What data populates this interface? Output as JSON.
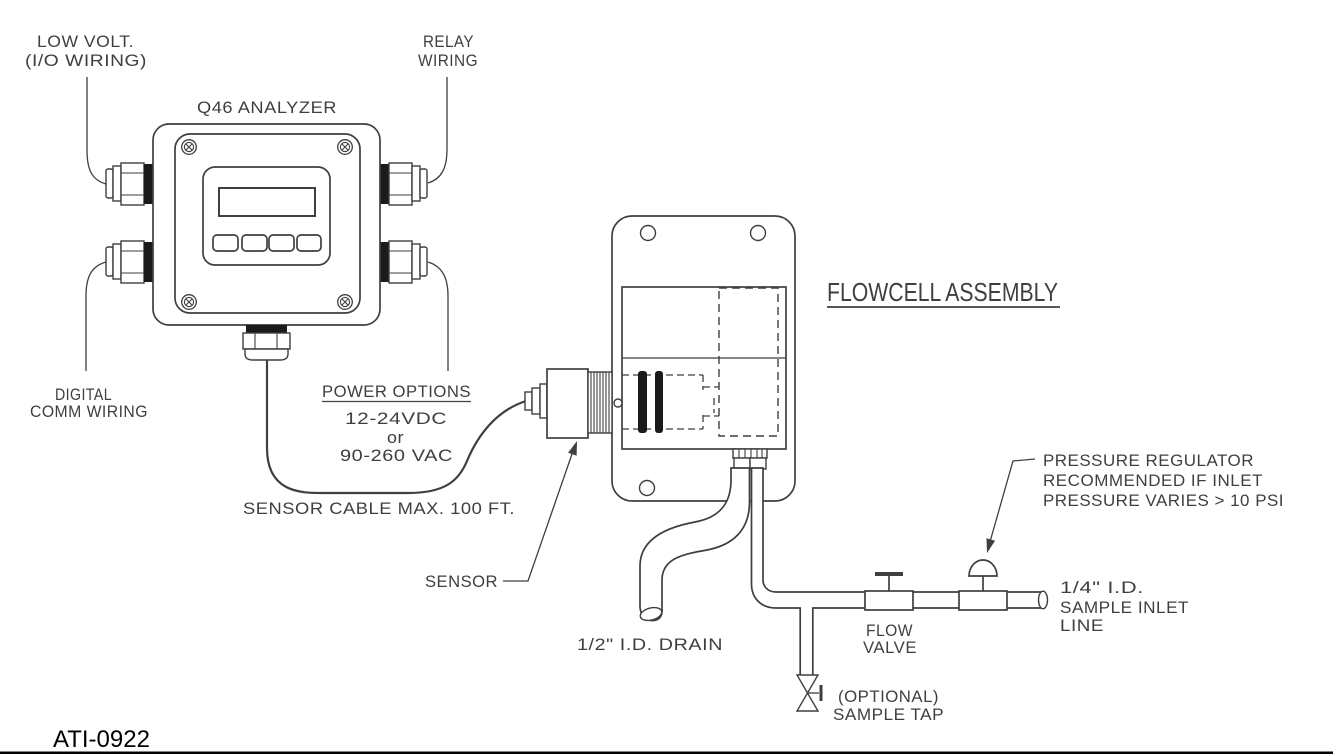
{
  "drawing": {
    "number": "ATI-0922"
  },
  "colors": {
    "line": "#3f3f3f",
    "dark_fill": "#1b1b1b",
    "background": "#ffffff",
    "footer_text": "#000000"
  },
  "analyzer": {
    "title": "Q46 ANALYZER",
    "wiring_labels": {
      "low_volt": [
        "LOW VOLT.",
        "(I/O WIRING)"
      ],
      "relay": [
        "RELAY",
        "WIRING"
      ],
      "digital_comm": [
        "DIGITAL",
        "COMM WIRING"
      ]
    },
    "power": {
      "heading": "POWER OPTIONS",
      "options": [
        "12-24VDC",
        "or",
        "90-260 VAC"
      ]
    },
    "cable_note": "SENSOR CABLE MAX. 100 FT."
  },
  "flowcell": {
    "heading": "FLOWCELL ASSEMBLY",
    "sensor_label": "SENSOR",
    "drain_label": "1/2\" I.D. DRAIN",
    "flow_valve": [
      "FLOW",
      "VALVE"
    ],
    "regulator_note": [
      "PRESSURE REGULATOR",
      "RECOMMENDED IF INLET",
      "PRESSURE VARIES > 10 PSI"
    ],
    "inlet_label": [
      "1/4\" I.D.",
      "SAMPLE INLET",
      "LINE"
    ],
    "sample_tap": [
      "(OPTIONAL)",
      "SAMPLE TAP"
    ]
  }
}
